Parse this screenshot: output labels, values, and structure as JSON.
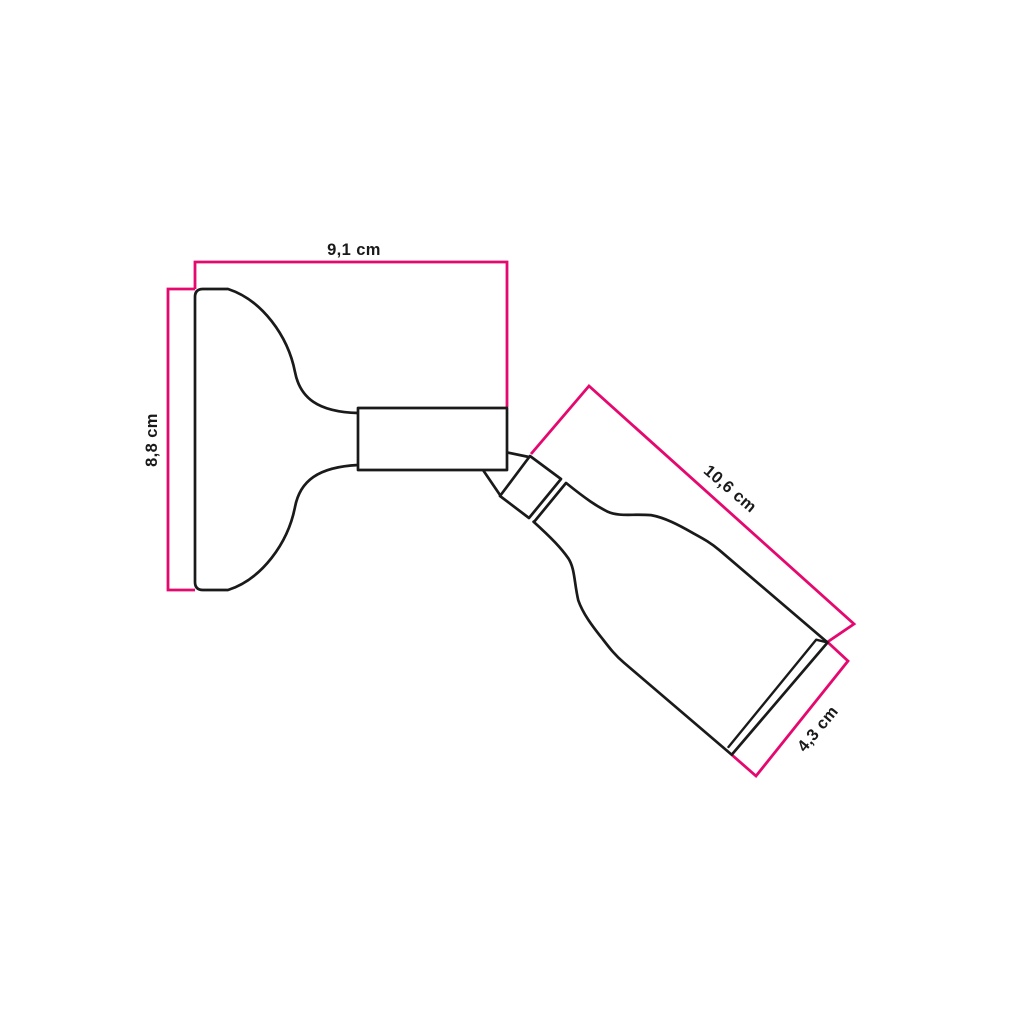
{
  "diagram": {
    "title": "Adjustable wall spotlight dimension drawing",
    "colors": {
      "dimension_line": "#e5086f",
      "outline": "#1a1a1a",
      "background": "#ffffff"
    },
    "dimensions": {
      "base_width": {
        "label": "9,1 cm",
        "value_cm": 9.1
      },
      "base_height": {
        "label": "8,8 cm",
        "value_cm": 8.8
      },
      "holder_length": {
        "label": "10,6 cm",
        "value_cm": 10.6
      },
      "holder_diameter": {
        "label": "4,3 cm",
        "value_cm": 4.3
      }
    }
  }
}
